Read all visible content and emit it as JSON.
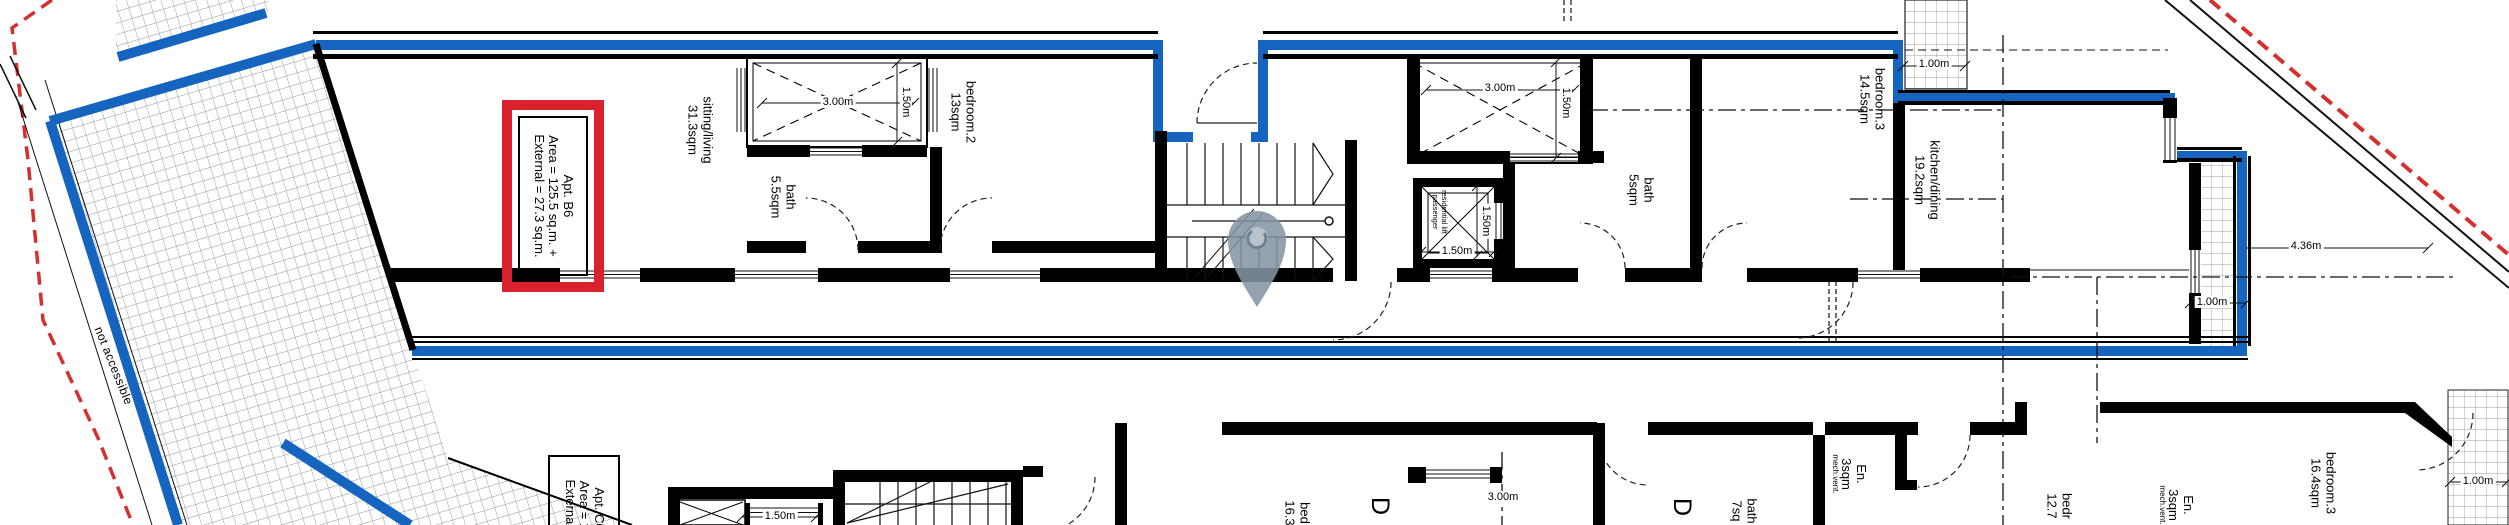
{
  "colors": {
    "boundary_blue": "#1565c0",
    "site_red": "#d3302f",
    "label_red": "#da222e",
    "pin_grey": "#8494a3",
    "wall_black": "#000000"
  },
  "labels": {
    "apt_b6": {
      "l1": "Apt. B6",
      "l2": "Area = 125.5 sq.m. +",
      "l3": "External = 27.3 sq.m."
    },
    "apt_c6": {
      "l1": "Apt. C6",
      "l2": "Area = 16",
      "l3": "External ="
    },
    "not_accessible": "not accessible",
    "lift": {
      "l1": "residential lift",
      "l2": "passenger"
    },
    "door_tag": "D"
  },
  "rooms": {
    "upper": {
      "sitting": {
        "name": "sitting/living",
        "area": "31.3sqm"
      },
      "bath1": {
        "name": "bath",
        "area": "5.5sqm"
      },
      "bedroom2": {
        "name": "bedroom.2",
        "area": "13sqm"
      },
      "bath2": {
        "name": "bath",
        "area": "5sqm"
      },
      "bedroom3": {
        "name": "bedroom.3",
        "area": "14.5sqm"
      },
      "kitchen": {
        "name": "kitchen/dining",
        "area": "19.2sqm"
      }
    },
    "lower": {
      "bedroom1": {
        "name": "bed",
        "area": "16.3"
      },
      "bath": {
        "name": "bath",
        "area": "7sq"
      },
      "ensuite1": {
        "name": "En.",
        "area": "3sqm",
        "note": "mech.vent."
      },
      "bedroom2": {
        "name": "bedr",
        "area": "12.7"
      },
      "ensuite2": {
        "name": "En.",
        "area": "3sqm",
        "note": "mech.vent."
      },
      "bedroom3": {
        "name": "bedroom.3",
        "area": "16.4sqm"
      }
    }
  },
  "dimensions": {
    "shaft1_w": "3.00m",
    "shaft1_d": "1.50m",
    "shaft2_w": "3.00m",
    "shaft2_d": "1.50m",
    "lift_w": "1.50m",
    "lift_d": "1.50m",
    "balcony_top": "1.00m",
    "balcony_right": "1.00m",
    "balcony_lower": "1.00m",
    "site_edge": "4.36m",
    "lower_shaft": "1.50m",
    "lower_room": "3.00m"
  }
}
